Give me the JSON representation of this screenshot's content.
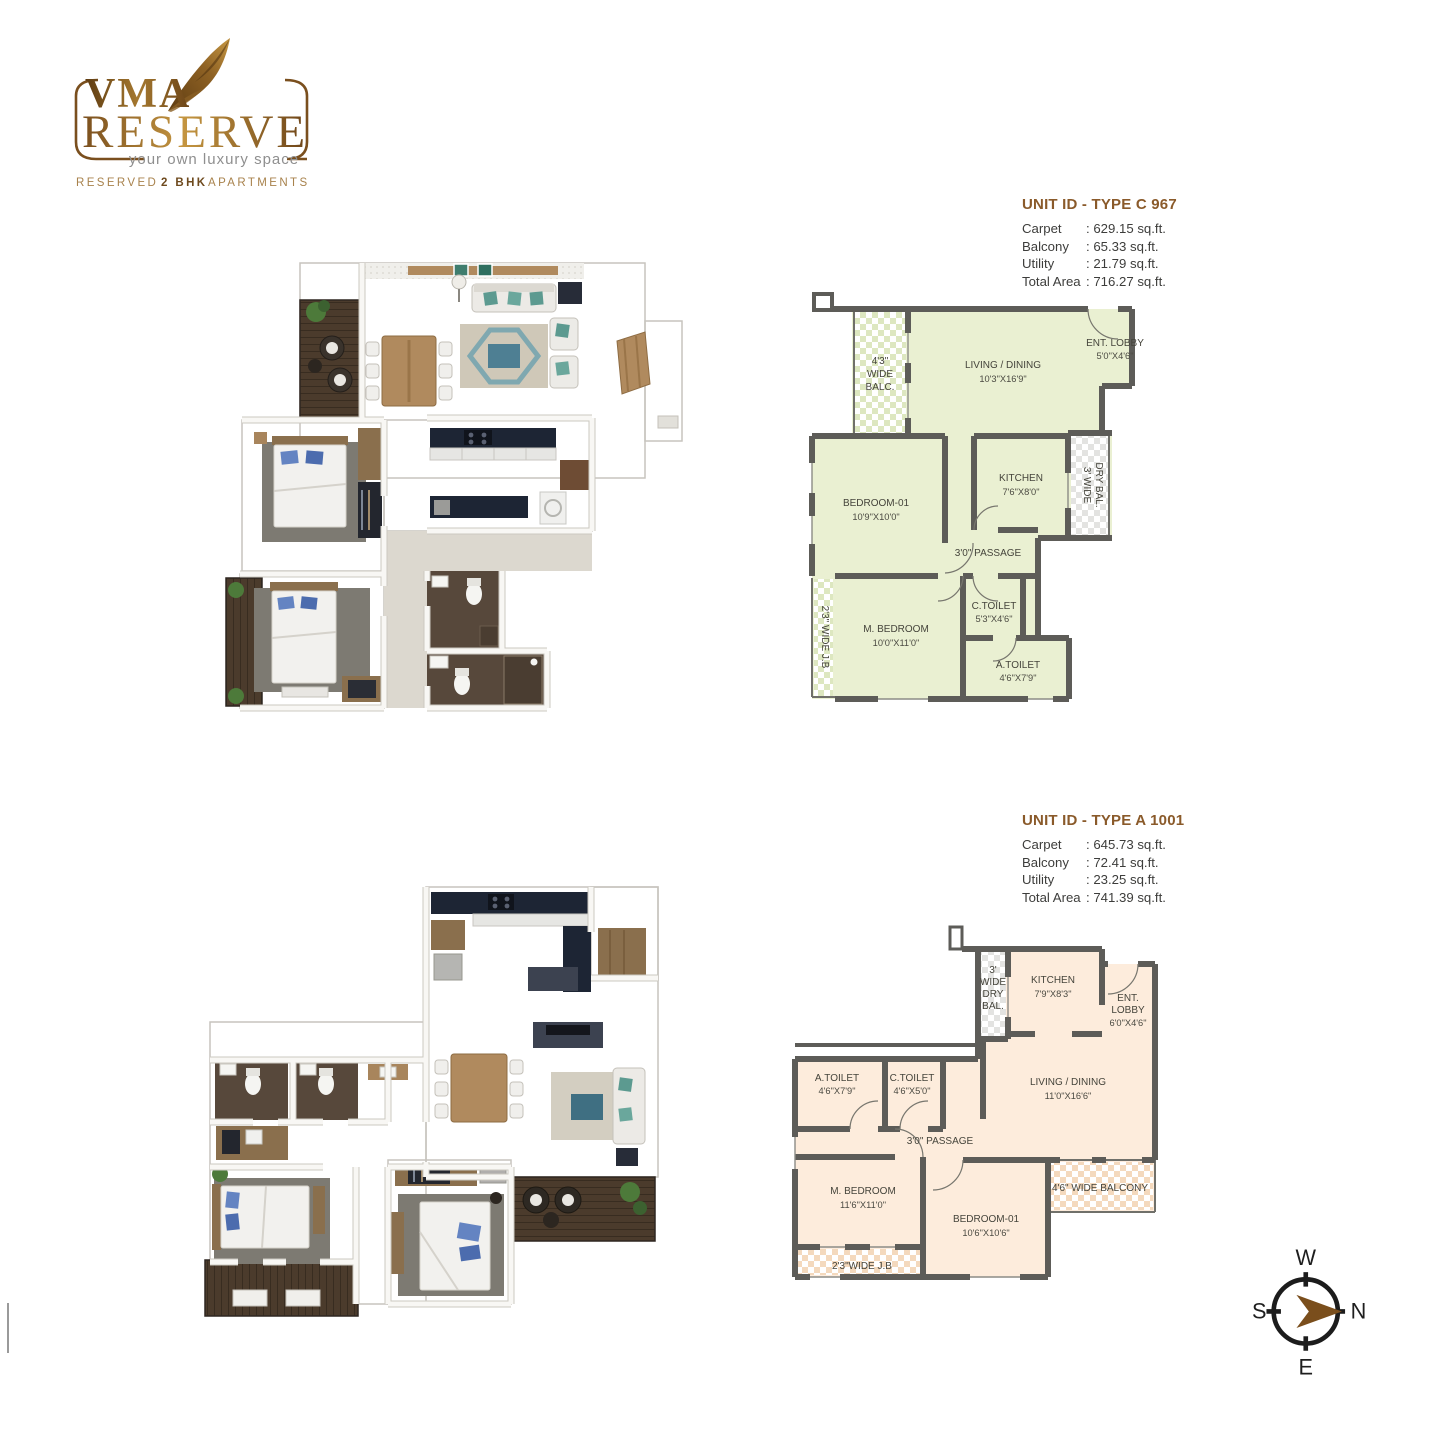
{
  "logo": {
    "brand": "VMA",
    "name": "RESERVE",
    "tagline": "your own luxury space",
    "subtitle": {
      "part1": "RESERVED",
      "part2": "2 BHK",
      "part3": "APARTMENTS"
    },
    "colors": {
      "brown": "#6e4a1e",
      "gold": "#b9893f",
      "gray": "#8f8f8f"
    }
  },
  "unit_c": {
    "title": "UNIT ID - TYPE C 967",
    "stats": {
      "carpet_label": "Carpet",
      "carpet_value": ": 629.15 sq.ft.",
      "balcony_label": "Balcony",
      "balcony_value": ": 65.33 sq.ft.",
      "utility_label": "Utility",
      "utility_value": ": 21.79 sq.ft.",
      "total_label": "Total Area",
      "total_value": ": 716.27 sq.ft."
    },
    "rooms": {
      "balc_l1": "4'3\"",
      "balc_l2": "WIDE",
      "balc_l3": "BALC.",
      "living_name": "LIVING / DINING",
      "living_dims": "10'3\"X16'9\"",
      "lobby_name": "ENT. LOBBY",
      "lobby_dims": "5'0\"X4'6\"",
      "kitchen_name": "KITCHEN",
      "kitchen_dims": "7'6\"X8'0\"",
      "drybal_l1": "3' WIDE",
      "drybal_l2": "DRY BAL.",
      "bedroom1_name": "BEDROOM-01",
      "bedroom1_dims": "10'9\"X10'0\"",
      "passage_name": "3'0\" PASSAGE",
      "jb_name": "2'3\" WIDE J.B",
      "mbedroom_name": "M. BEDROOM",
      "mbedroom_dims": "10'0\"X11'0\"",
      "ctoilet_name": "C.TOILET",
      "ctoilet_dims": "5'3\"X4'6\"",
      "atoilet_name": "A.TOILET",
      "atoilet_dims": "4'6\"X7'9\""
    }
  },
  "unit_a": {
    "title": "UNIT ID - TYPE A 1001",
    "stats": {
      "carpet_label": "Carpet",
      "carpet_value": ": 645.73 sq.ft.",
      "balcony_label": "Balcony",
      "balcony_value": ": 72.41 sq.ft.",
      "utility_label": "Utility",
      "utility_value": ": 23.25 sq.ft.",
      "total_label": "Total Area",
      "total_value": ": 741.39 sq.ft."
    },
    "rooms": {
      "drybal_l1": "3'",
      "drybal_l2": "WIDE",
      "drybal_l3": "DRY",
      "drybal_l4": "BAL.",
      "kitchen_name": "KITCHEN",
      "kitchen_dims": "7'9\"X8'3\"",
      "lobby_l1": "ENT.",
      "lobby_l2": "LOBBY",
      "lobby_dims": "6'0\"X4'6\"",
      "living_name": "LIVING / DINING",
      "living_dims": "11'0\"X16'6\"",
      "atoilet_name": "A.TOILET",
      "atoilet_dims": "4'6\"X7'9\"",
      "ctoilet_name": "C.TOILET",
      "ctoilet_dims": "4'6\"X5'0\"",
      "passage_name": "3'0\" PASSAGE",
      "mbedroom_name": "M. BEDROOM",
      "mbedroom_dims": "11'6\"X11'0\"",
      "bedroom1_name": "BEDROOM-01",
      "bedroom1_dims": "10'6\"X10'6\"",
      "balcony_name": "4'6\" WIDE BALCONY",
      "jb_name": "2'3\"WIDE J.B"
    }
  },
  "compass": {
    "w": "W",
    "s": "S",
    "e": "E",
    "n": "N"
  },
  "colors": {
    "title_brown": "#8a5a2a",
    "plan_c_fill": "#eaf0d2",
    "plan_a_fill": "#fdecdc",
    "wall_gray": "#5d5c58"
  }
}
